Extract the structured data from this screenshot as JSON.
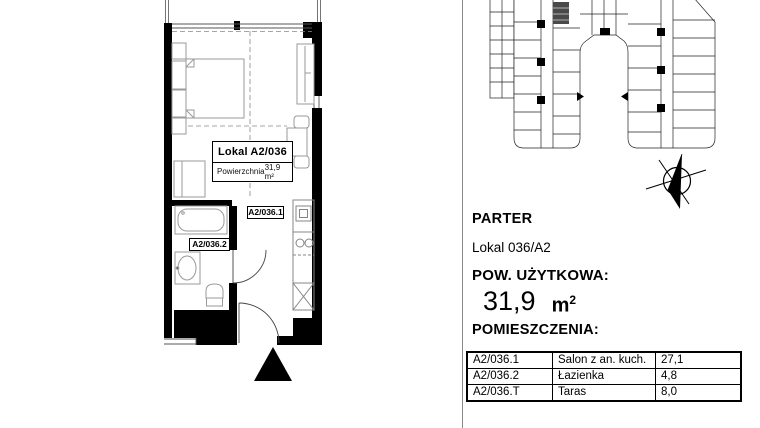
{
  "colors": {
    "wall": "#000000",
    "furniture_stroke": "#9a9a9a",
    "dashed_guide": "#888888",
    "divider": "#8a8a8a"
  },
  "floor_plan": {
    "label_box": {
      "title_word": "Lokal",
      "unit": "A2/036",
      "area_label": "Powierzchnia",
      "area_value": "31,9 m²"
    },
    "room_tags": {
      "salon": "A2/036.1",
      "bathroom": "A2/036.2"
    }
  },
  "panel": {
    "floor_label": "PARTER",
    "unit_label": "Lokal 036/A2",
    "area_heading": "POW. UŻYTKOWA:",
    "area_value": "31,9",
    "area_unit_base": "m",
    "area_unit_sup": "2",
    "rooms_heading": "POMIESZCZENIA:",
    "rooms": [
      {
        "code": "A2/036.1",
        "name": "Salon z an. kuch.",
        "area": "27,1"
      },
      {
        "code": "A2/036.2",
        "name": "Łazienka",
        "area": "4,8"
      },
      {
        "code": "A2/036.T",
        "name": "Taras",
        "area": "8,0"
      }
    ]
  }
}
